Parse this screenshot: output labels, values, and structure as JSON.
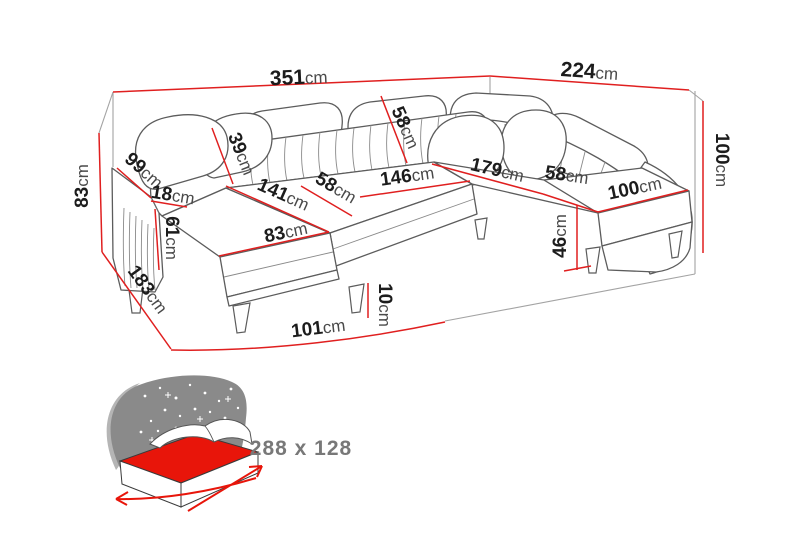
{
  "diagram": {
    "unit": "cm",
    "colors": {
      "dimension_red": "#e01f1f",
      "outline_gray": "#5c5c5c",
      "room_gray": "#a3a3a3",
      "label_number": "#1c1c1c",
      "label_unit": "#4a4a4a",
      "bed_mattress_red": "#e8150a",
      "bed_icon_gray": "#8a8a8a",
      "bed_text_gray": "#787878"
    },
    "dimensions": {
      "total_width": "351cm",
      "total_depth": "224cm",
      "back_height_left": "83cm",
      "armrest_top_width": "99cm",
      "armrest_thickness": "18cm",
      "armrest_front_height": "61cm",
      "backrest_depth": "39cm",
      "chaise_length": "141cm",
      "chaise_width": "83cm",
      "seat_depth_left": "58cm",
      "seat_width_middle": "146cm",
      "backrest_corner_width": "58cm",
      "seat_length_right": "179cm",
      "seat_depth_right": "58cm",
      "end_seat_width": "100cm",
      "back_height_right": "100cm",
      "seat_front_height": "46cm",
      "leg_height": "10cm",
      "side_depth_left": "183cm",
      "front_width_left": "101cm"
    },
    "bed_icon": {
      "sleeping_area": "288 x 128"
    }
  }
}
